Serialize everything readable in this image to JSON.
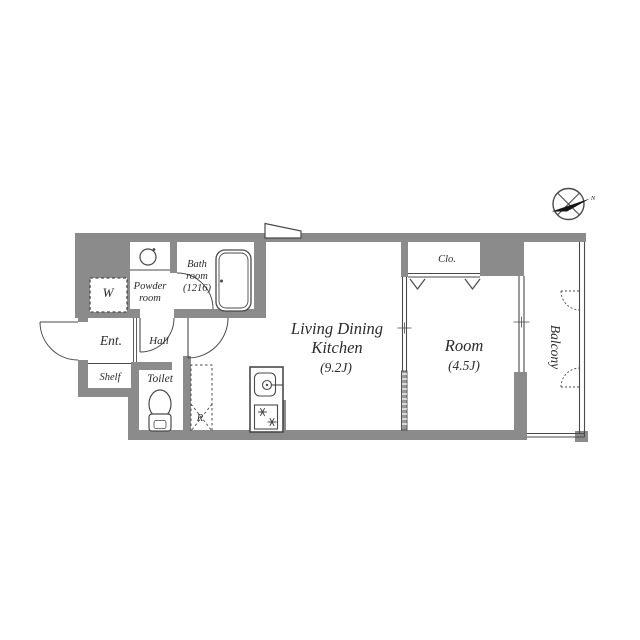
{
  "rooms": {
    "ldk": {
      "line1": "Living Dining",
      "line2": "Kitchen",
      "area": "(9.2J)"
    },
    "bedroom": {
      "name": "Room",
      "area": "(4.5J)"
    },
    "balcony": {
      "name": "Balcony"
    },
    "closet": {
      "name": "Clo."
    },
    "wardrobe": {
      "name": "W"
    },
    "powder": {
      "line1": "Powder",
      "line2": "room"
    },
    "bath": {
      "line1": "Bath",
      "line2": "room",
      "line3": "(1216)"
    },
    "entrance": {
      "name": "Ent."
    },
    "hall": {
      "name": "Hall"
    },
    "shelf": {
      "name": "Shelf"
    },
    "toilet": {
      "name": "Toilet"
    },
    "refrigerator": {
      "name": "R"
    }
  },
  "compass": {
    "north": "N"
  },
  "colors": {
    "wall": "#8b8b8b",
    "line": "#4a4a4a",
    "text": "#2b2b2b",
    "pocket_fill": "#9a9a9a",
    "needle": "#151515"
  }
}
